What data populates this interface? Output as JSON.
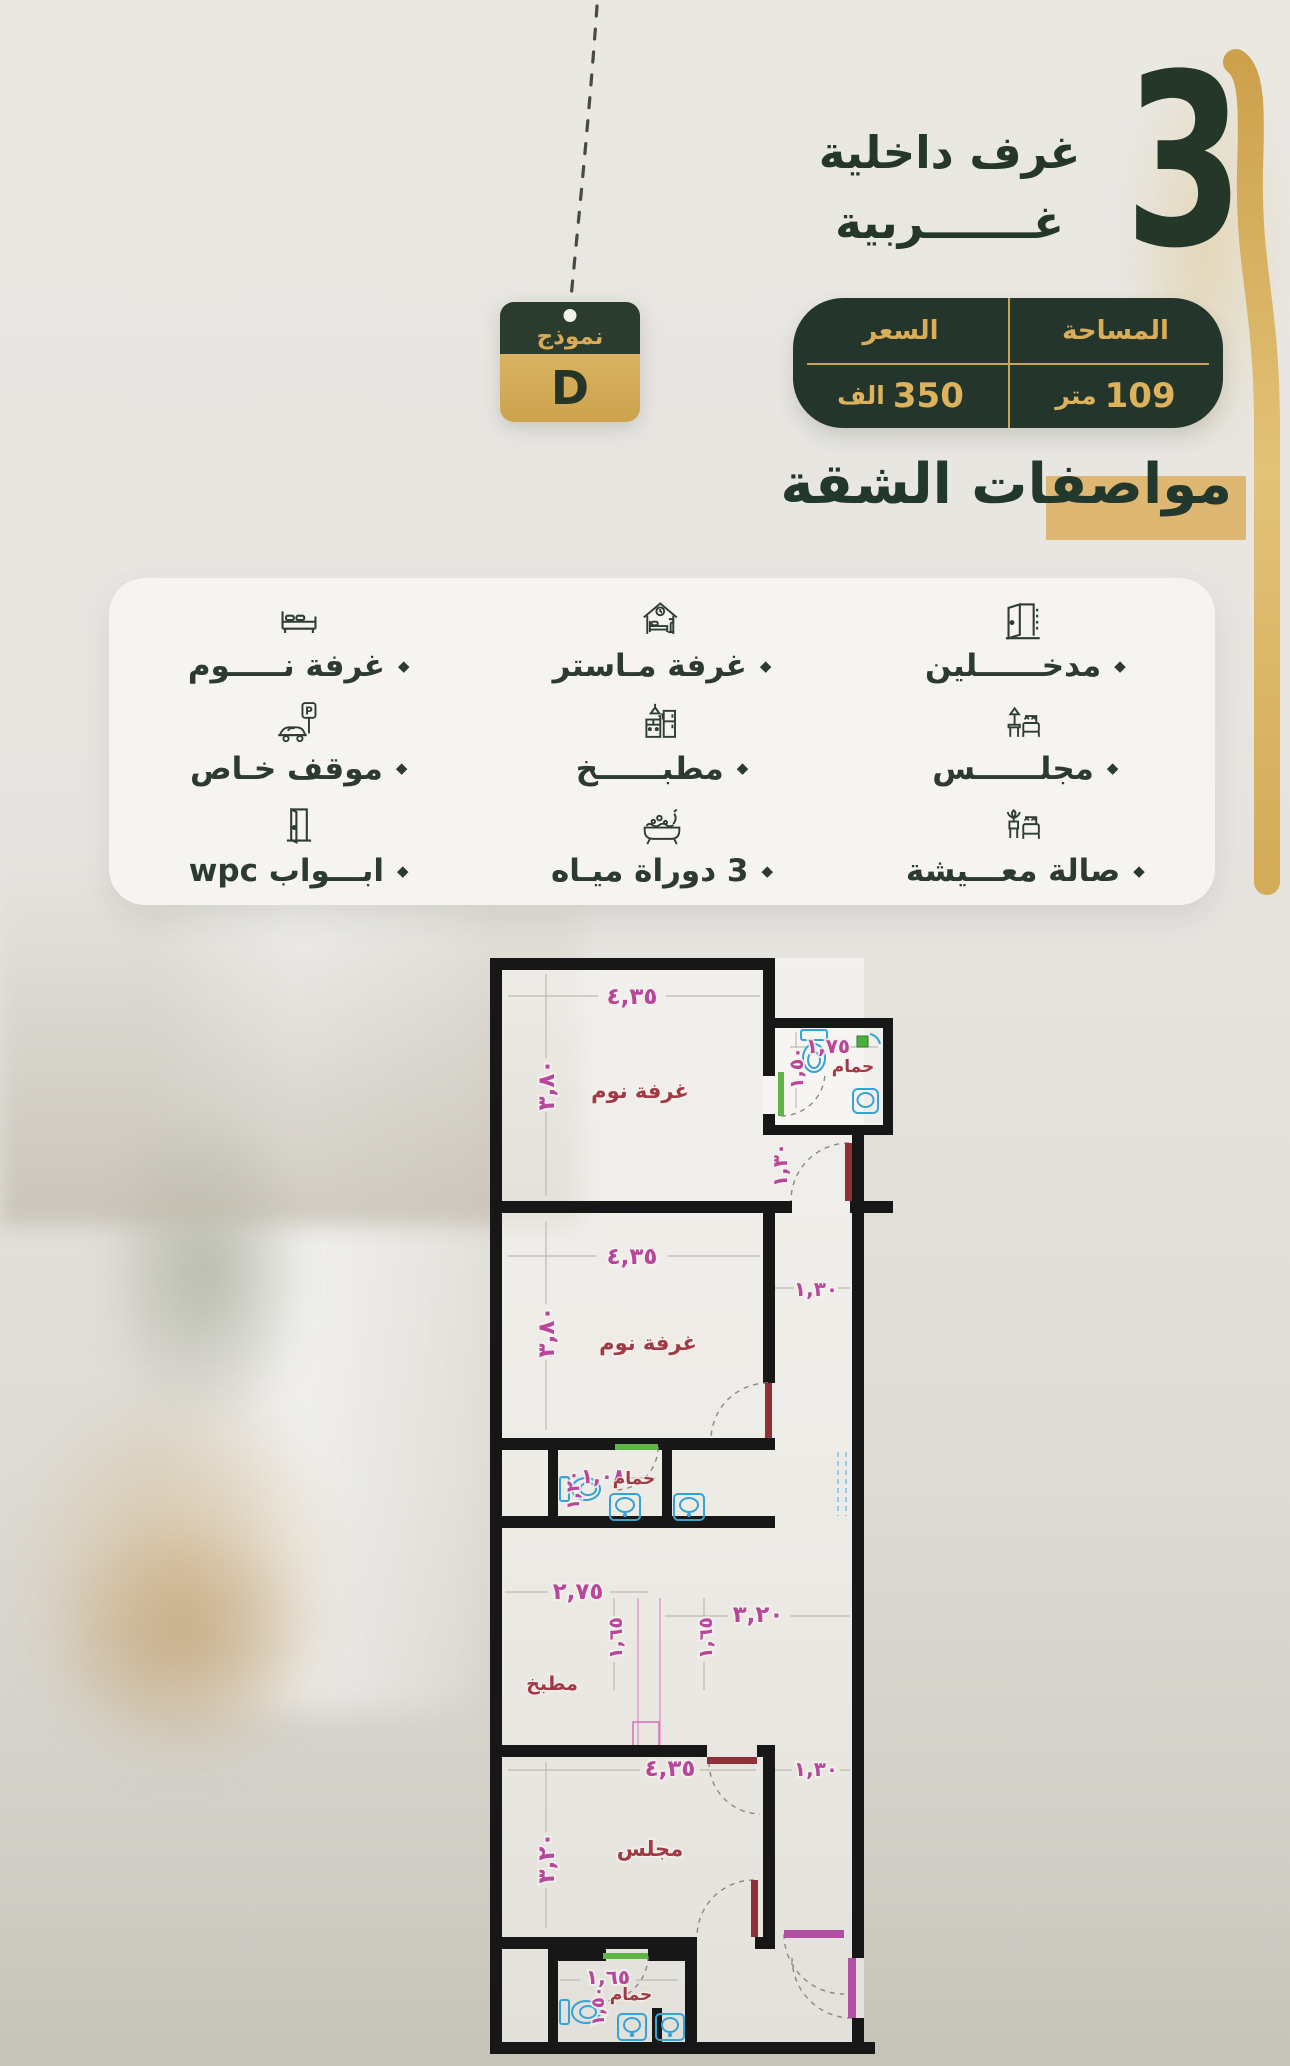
{
  "hero": {
    "big_number": "3",
    "line1": "غرف داخلية",
    "line2": "غـــــــربية"
  },
  "model_badge": {
    "label": "نموذج",
    "value": "D"
  },
  "stats_table": {
    "area_header": "المساحة",
    "area_number": "109",
    "area_unit": "متر",
    "price_header": "السعر",
    "price_number": "350",
    "price_unit": "الف"
  },
  "section_title": "مواصفات الشقة",
  "features": {
    "bullet": "◆",
    "parking_letter": "P",
    "items": [
      {
        "label": "مدخــــــلين"
      },
      {
        "label": "غرفة مـاستر"
      },
      {
        "label": "غرفة نـــــوم"
      },
      {
        "label": "مجلــــــس"
      },
      {
        "label": "مطبــــــخ"
      },
      {
        "label": "موقف خـاص"
      },
      {
        "label": "صالة معـــيشة"
      },
      {
        "label": "3 دوراة ميـاه"
      },
      {
        "label": "ابـــواب wpc"
      }
    ]
  },
  "floor_plan": {
    "bed1_name": "غرفة نوم",
    "bed1_w": "٤,٣٥",
    "bed1_h": "٣,٨٠",
    "bath1_name": "حمام",
    "bath1_w": "١,٧٥",
    "bath1_h": "١,٥٠",
    "hall1": "١,٣٠",
    "bed2_name": "غرفة نوم",
    "bed2_w": "٤,٣٥",
    "bed2_h": "٣,٨٠",
    "hall2": "١,٣٠",
    "bath2_name": "حمام",
    "bath2_w": "١,٠٨",
    "bath2_h": "١,٢٠",
    "kitchen_name": "مطبخ",
    "kitchen_w": "٢,٧٥",
    "kitchen_top": "٣,٢٠",
    "kitchen_d1": "١,٦٥",
    "kitchen_d2": "١,٦٥",
    "majlis_name": "مجلس",
    "majlis_w": "٤,٣٥",
    "majlis_h": "٣,٢٠",
    "hall3": "١,٣٠",
    "bath3_name": "حمام",
    "bath3_w": "١,٦٥",
    "bath3_h": "١,٥٠"
  },
  "colors": {
    "dark_green": "#243629",
    "gold": "#d2a95a",
    "table_text_gold": "#d9ad58",
    "highlight": "#dcae5e",
    "dim_pink": "#b8469b",
    "room_maroon": "#a03a44",
    "door_red": "#8f2f38",
    "door_green": "#57b33e",
    "door_magenta": "#b14fa4",
    "fixture_blue": "#3fa9d5"
  }
}
